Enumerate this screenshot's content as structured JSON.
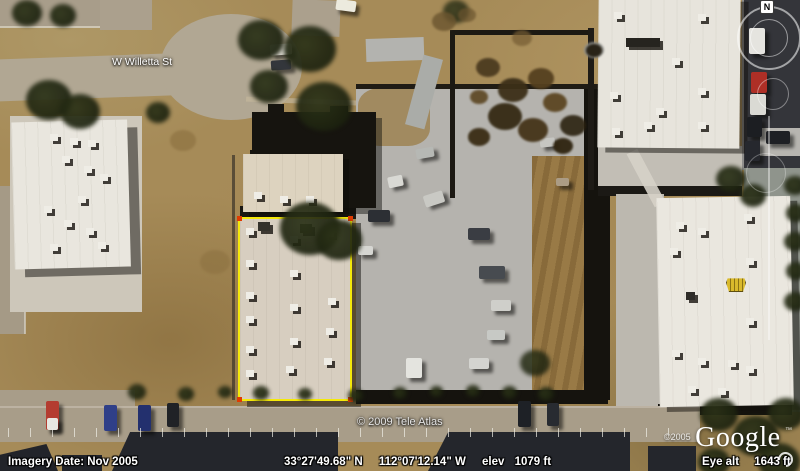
{
  "overlay": {
    "street_label": "W Willetta St",
    "tile_copyright": "© 2009 Tele Atlas",
    "watermark": {
      "year": "©2005",
      "logo": "Google",
      "tm": "™"
    },
    "navigation": {
      "north_label": "N"
    }
  },
  "status_bar": {
    "imagery_date": "Imagery Date: Nov 2005",
    "latitude": "33°27'49.68\" N",
    "longitude": "112°07'12.14\" W",
    "elevation_label": "elev",
    "elevation_value": "1079 ft",
    "eye_altitude_label": "Eye alt",
    "eye_altitude_value": "1643 ft"
  },
  "colors": {
    "parcel_outline": "#f5e90a",
    "parcel_corner_marker": "#e03a00",
    "roof_logo_yellow": "#d9b92c",
    "roof_white": "#e9e6de",
    "dirt": "#a68b58",
    "concrete": "#b5b3ae"
  }
}
